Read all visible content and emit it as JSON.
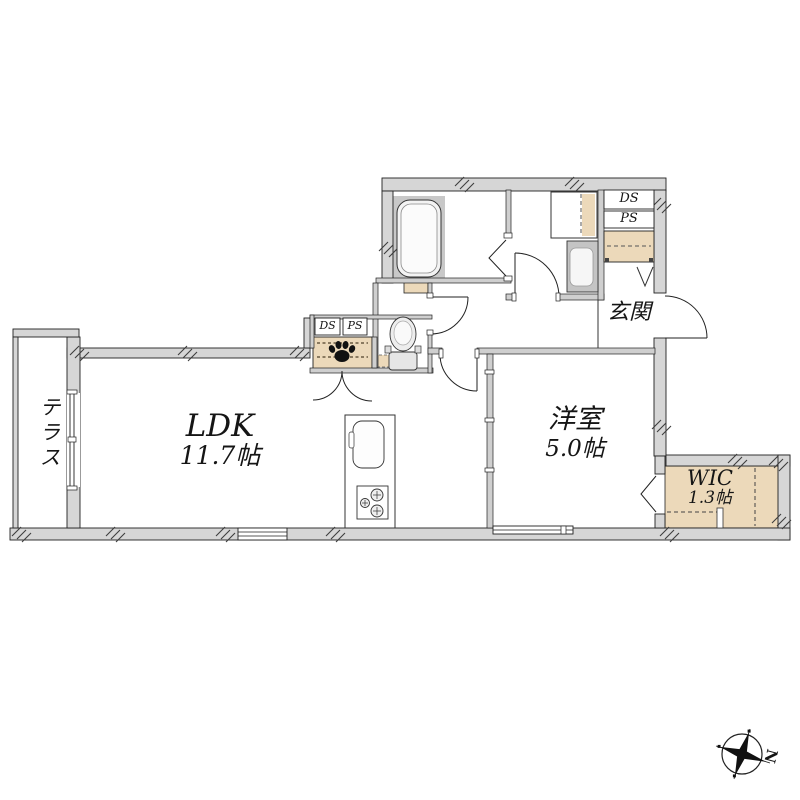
{
  "floorplan": {
    "rooms": {
      "ldk": {
        "name": "LDK",
        "area": "11.7帖"
      },
      "bedroom": {
        "name": "洋室",
        "area": "5.0帖"
      },
      "wic": {
        "name": "WIC",
        "area": "1.3帖"
      },
      "entrance": {
        "name": "玄関"
      },
      "terrace": {
        "name": "テラス"
      }
    },
    "shafts": {
      "mid": {
        "ds": "DS",
        "ps": "PS"
      },
      "entrance": {
        "ds": "DS",
        "ps": "PS"
      }
    },
    "compass": {
      "north": "N"
    },
    "icons": [
      "bathtub-icon",
      "toilet-icon",
      "washbasin-icon",
      "washing-machine-pan-icon",
      "kitchen-sink-icon",
      "gas-stove-icon",
      "paw-print-icon",
      "shoe-cabinet-icon",
      "compass-icon",
      "folding-door-icon",
      "door-swing-icon"
    ],
    "colors": {
      "wall_fill": "#d6d6d6",
      "line": "#222222",
      "storage_beige": "#ecd9ba",
      "bath_floor": "#c8c8c8",
      "fixture_gray": "#c4c4c4"
    }
  }
}
